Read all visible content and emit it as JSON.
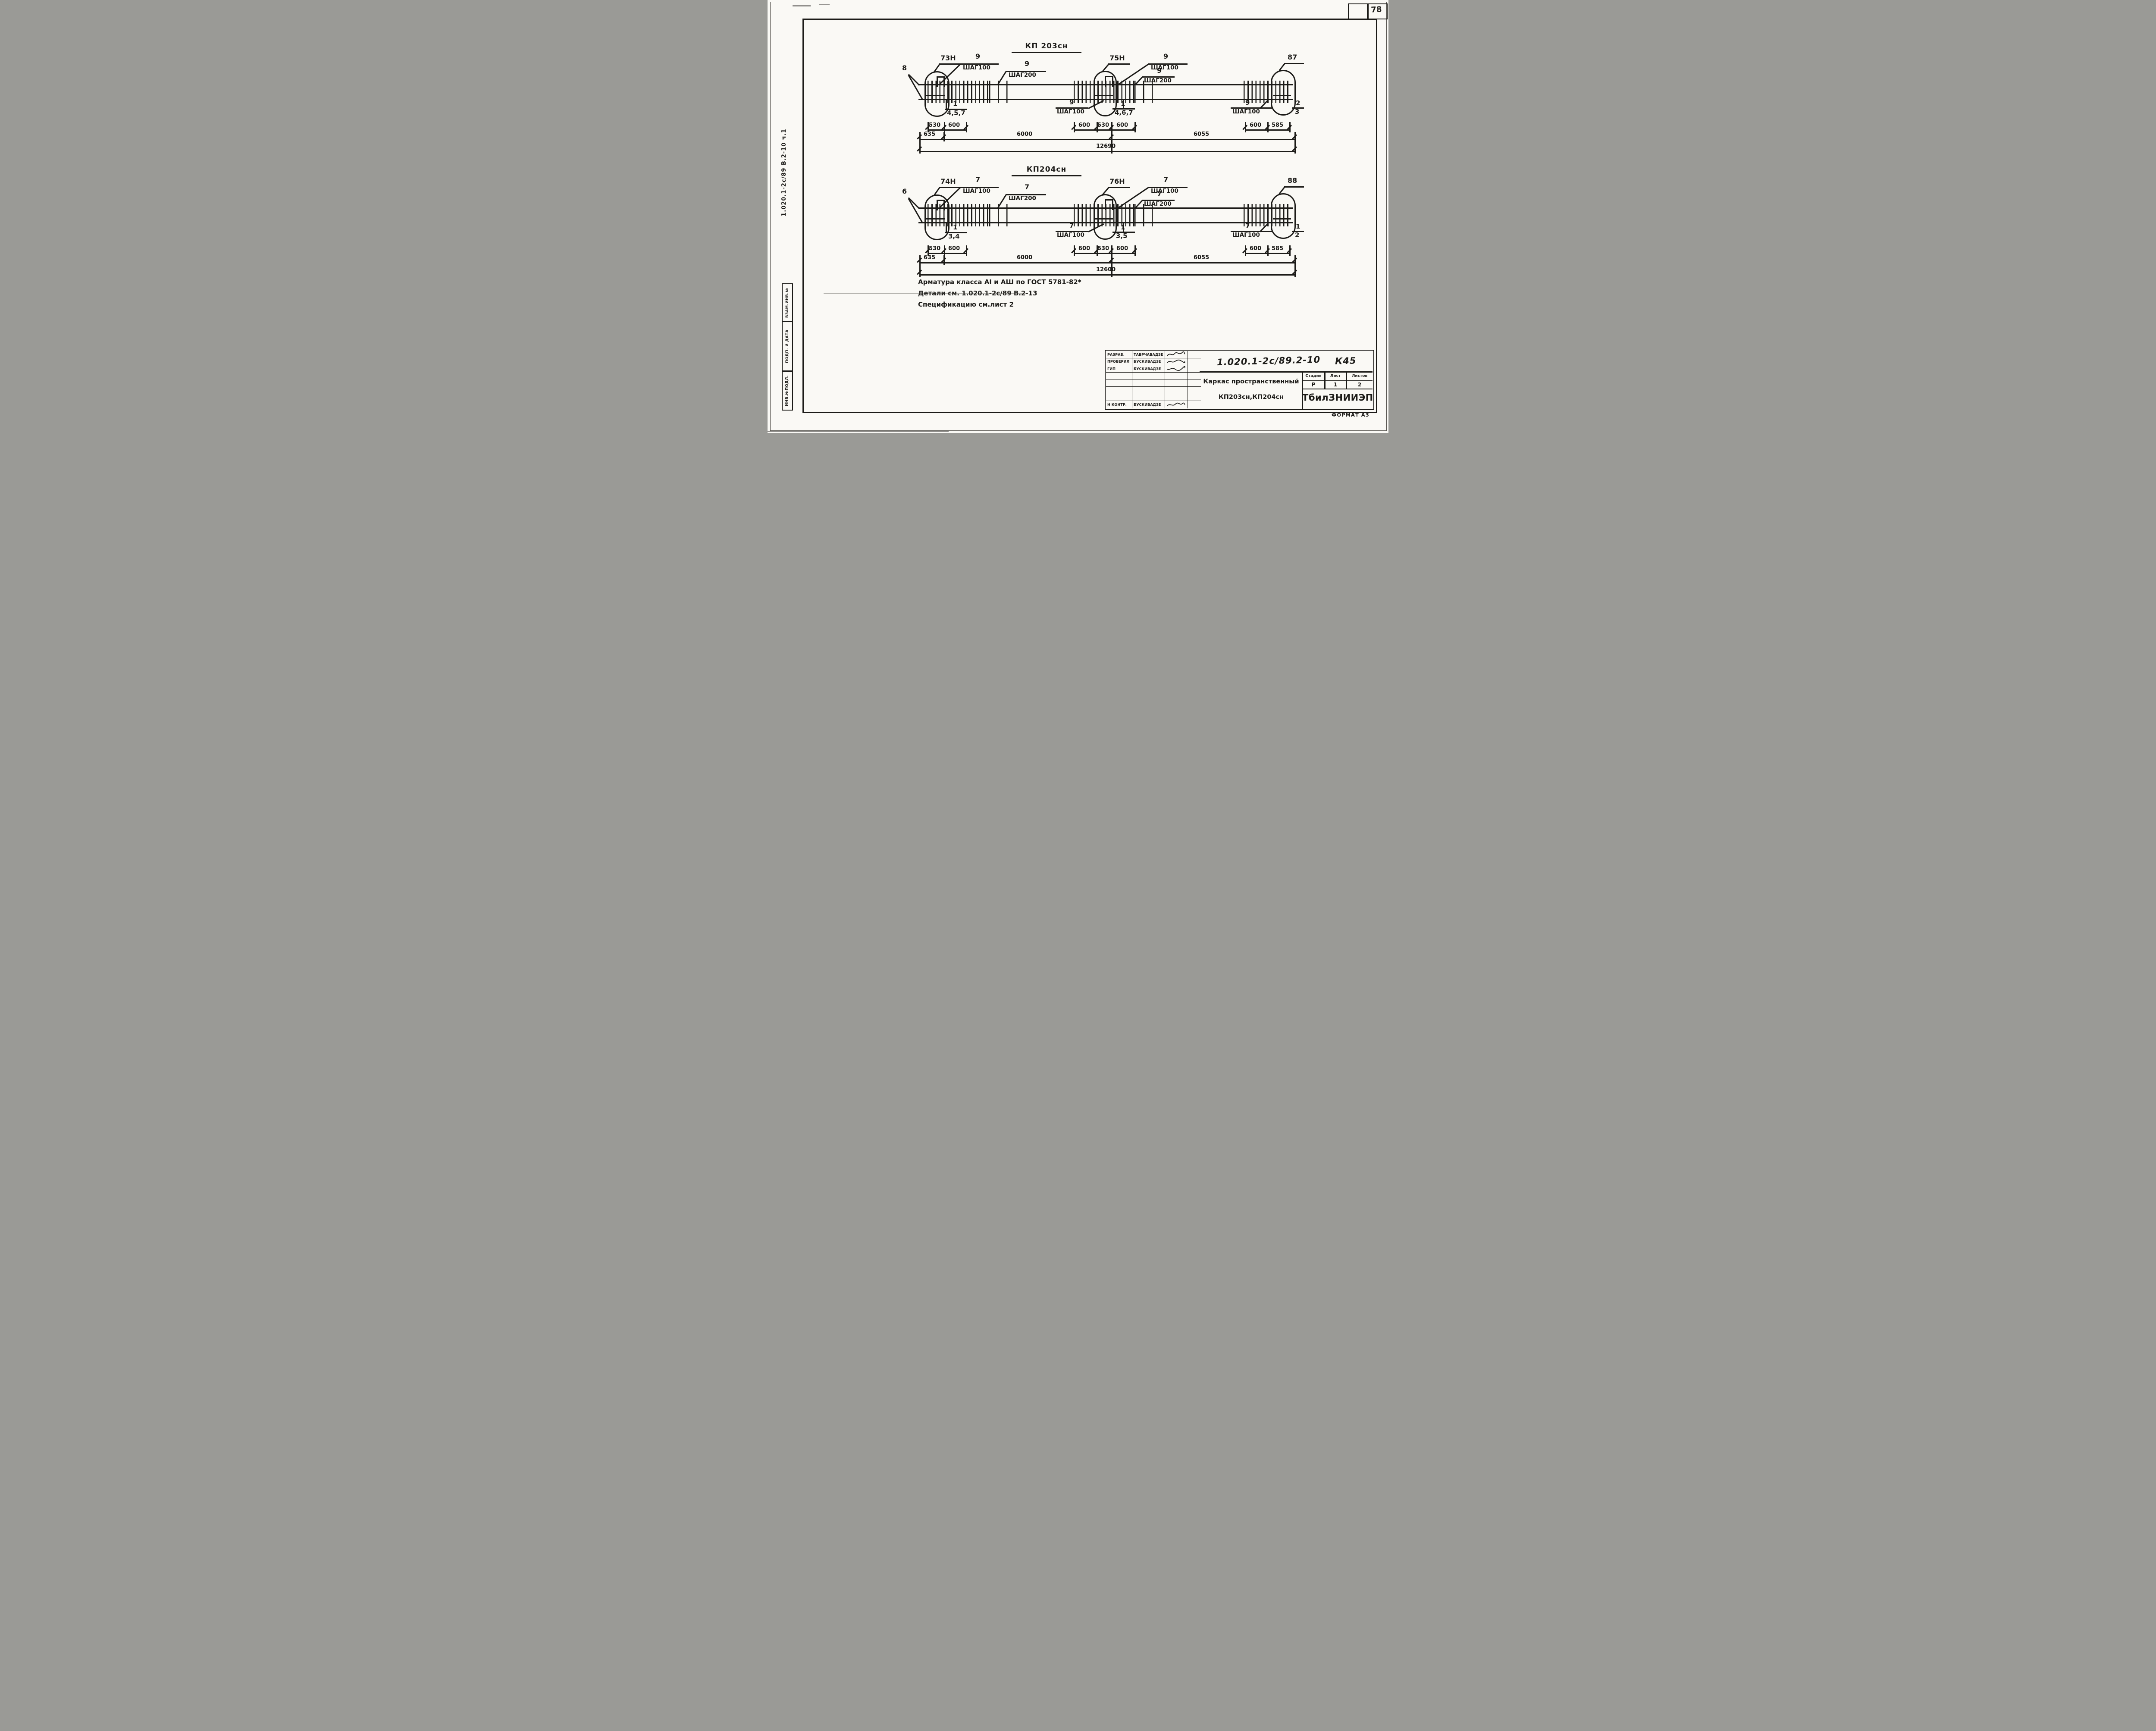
{
  "page": {
    "number": "78",
    "format_note": "ФОРМАТ А3"
  },
  "margin": {
    "doc_ref": "1.020.1-2с/89 В.2-10 ч.1",
    "stamp_vzam": "ВЗАМ.ИНВ.№",
    "stamp_podp": "ПОДП. И ДАТА",
    "stamp_inv": "ИНВ.№ПОДЛ."
  },
  "d1": {
    "title": "КП 203сн",
    "end_pos": "8",
    "det1_pos": "73Н",
    "det2_pos": "75Н",
    "det3_pos": "87",
    "s1_num": "9",
    "s1_step": "ШАГ100",
    "s2_num": "9",
    "s2_step": "ШАГ200",
    "s3_num": "9",
    "s3_step": "ШАГ100",
    "s4_num": "9",
    "s4_step": "ШАГ200",
    "b1_num": "1",
    "b1_items": "4,5,7",
    "b2_num": "9",
    "b2_step": "ШАГ100",
    "b3_num": "1",
    "b3_items": "4,6,7",
    "b4_num": "9",
    "b4_step": "ШАГ100",
    "fr_top": "2",
    "fr_bot": "3",
    "dimA": [
      "530",
      "600",
      "600",
      "530",
      "600",
      "600",
      "585"
    ],
    "dimB": [
      "635",
      "6000",
      "6055"
    ],
    "total": "12690"
  },
  "d2": {
    "title": "КП204сн",
    "end_pos": "6",
    "det1_pos": "74Н",
    "det2_pos": "76Н",
    "det3_pos": "88",
    "s1_num": "7",
    "s1_step": "ШАГ100",
    "s2_num": "7",
    "s2_step": "ШАГ200",
    "s3_num": "7",
    "s3_step": "ШАГ100",
    "s4_num": "7",
    "s4_step": "ШАГ200",
    "b1_num": "1",
    "b1_items": "3,4",
    "b2_num": "7",
    "b2_step": "ШАГ100",
    "b3_num": "1",
    "b3_items": "3,5",
    "b4_num": "7",
    "b4_step": "ШАГ100",
    "fr_top": "1",
    "fr_bot": "2",
    "dimA": [
      "530",
      "600",
      "600",
      "530",
      "600",
      "600",
      "585"
    ],
    "dimB": [
      "635",
      "6000",
      "6055"
    ],
    "total": "12600"
  },
  "notes": {
    "line1": "Арматура класса АI и АШ по ГОСТ 5781-82*",
    "line2": "Детали см. 1.020.1-2с/89 В.2-13",
    "line3": "Спецификацию см.лист 2"
  },
  "titleblock": {
    "doc_no": "1.020.1-2с/89.2-10",
    "code": "К45",
    "rows": [
      {
        "role": "РАЗРАБ.",
        "name": "ТАВРЧАВАДЗЕ"
      },
      {
        "role": "ПРОВЕРИЛ",
        "name": "БУСКИВАДЗЕ"
      },
      {
        "role": "ГИП",
        "name": "БУСКИВАДЗЕ"
      },
      {
        "role": "Н КОНТР.",
        "name": "БУСКИВАДЗЕ"
      }
    ],
    "title_line1": "Каркас пространственный",
    "title_line2": "КП203сн,КП204сн",
    "stage_h": "Стадия",
    "sheet_h": "Лист",
    "sheets_h": "Листов",
    "stage_v": "Р",
    "sheet_v": "1",
    "sheets_v": "2",
    "org": "ТбилЗНИИЭП"
  }
}
